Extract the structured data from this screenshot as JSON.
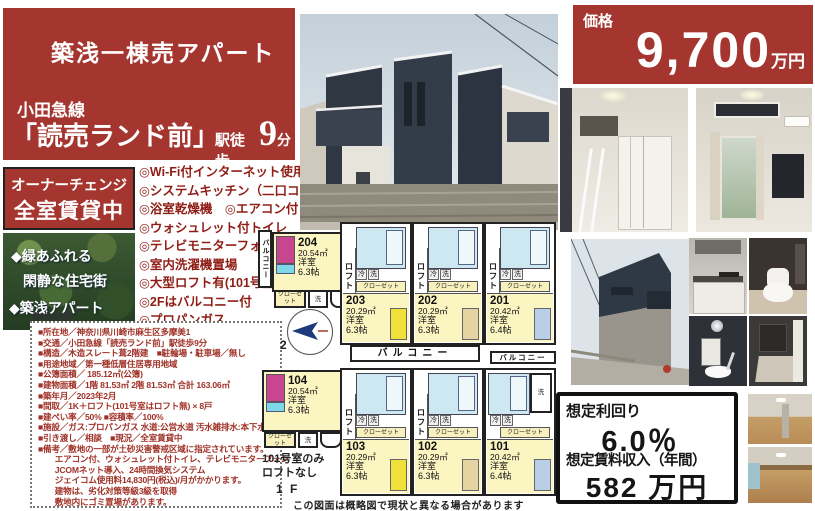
{
  "title_box": {
    "title": "築浅一棟売アパート",
    "line": "小田急線",
    "station": "「読売ランド前」",
    "station_suffix": "駅徒歩",
    "minutes": "9",
    "minutes_unit": "分"
  },
  "badge": {
    "line1": "オーナーチェンジ",
    "line2": "全室賃貸中"
  },
  "green_panel": {
    "line1": "◆緑あふれる",
    "line2": "閑静な住宅街",
    "line3": "◆築浅アパート"
  },
  "features": {
    "items": [
      "◎Wi-Fi付インターネット使用料無料",
      "◎システムキッチン（二口コンロ）",
      "◎浴室乾燥機　◎エアコン付",
      "◎ウォシュレット付トイレ",
      "◎テレビモニターフォン",
      "◎室内洗濯機置場",
      "◎大型ロフト有(101号室は有りません)",
      "◎2Fはバルコニー付",
      "◎プロパンガス"
    ]
  },
  "overview": {
    "label": "物件概要",
    "lines": [
      "■所在地／神奈川県川崎市麻生区多摩美1",
      "■交通／小田急線「読売ランド前」駅徒歩9分",
      "■構造／木造スレート葺2階建　■駐輪場・駐車場／無し",
      "■用途地域／第一種低層住居専用地域",
      "■公簿面積／ 185.12㎡(公簿)",
      "■建物面積／1階 81.53㎡ 2階 81.53㎡ 合計 163.06㎡",
      "■築年月／2023年2月",
      "■間取／1K＋ロフト(101号室はロフト無) × 8戸",
      "■建ぺい率／50% ■容積率／100%",
      "■施設／ガス:プロパンガス 水道:公営水道 汚水雑排水:本下水",
      "■引き渡し／相談　■現況／全室賃貸中",
      "■備考／敷地の一部が土砂災害警戒区域に指定されています。",
      "　　エアコン付、ウォシュレット付トイレ、テレビモニターフォン",
      "　　JCOMネット導入、24時間換気システム",
      "　　ジェイコム使用料14,830円(税込)/月がかかります。",
      "　　建物は、劣化対策等級3級を取得",
      "　　敷地内にゴミ置場があります。"
    ]
  },
  "price_box": {
    "label": "価格",
    "value": "9,700",
    "unit": "万円"
  },
  "yield_box": {
    "label": "想定利回り",
    "rate": "6.0％",
    "income_label": "想定賃料収入（年間）",
    "income": "582 万円"
  },
  "floorplan": {
    "disclaimer": "この図面は概略図で現状と異なる場合があります",
    "labels": {
      "loft": "ロフト",
      "balcony": "バルコニー",
      "closet": "クローゼット",
      "fridge": "冷",
      "washer": "洗",
      "room_type": "洋室"
    },
    "f2": {
      "floor_label": "2 F",
      "rooms": [
        {
          "no": "204",
          "area": "20.54㎡",
          "size": "6.3帖"
        },
        {
          "no": "203",
          "area": "20.29㎡",
          "size": "6.3帖"
        },
        {
          "no": "202",
          "area": "20.29㎡",
          "size": "6.3帖"
        },
        {
          "no": "201",
          "area": "20.42㎡",
          "size": "6.4帖"
        }
      ]
    },
    "f1": {
      "floor_label": "1 F",
      "note_line1": "101号室のみ",
      "note_line2": "ロフトなし",
      "rooms": [
        {
          "no": "104",
          "area": "20.54㎡",
          "size": "6.3帖"
        },
        {
          "no": "103",
          "area": "20.29㎡",
          "size": "6.3帖"
        },
        {
          "no": "102",
          "area": "20.29㎡",
          "size": "6.3帖"
        },
        {
          "no": "101",
          "area": "20.42㎡",
          "size": "6.4帖"
        }
      ]
    }
  }
}
